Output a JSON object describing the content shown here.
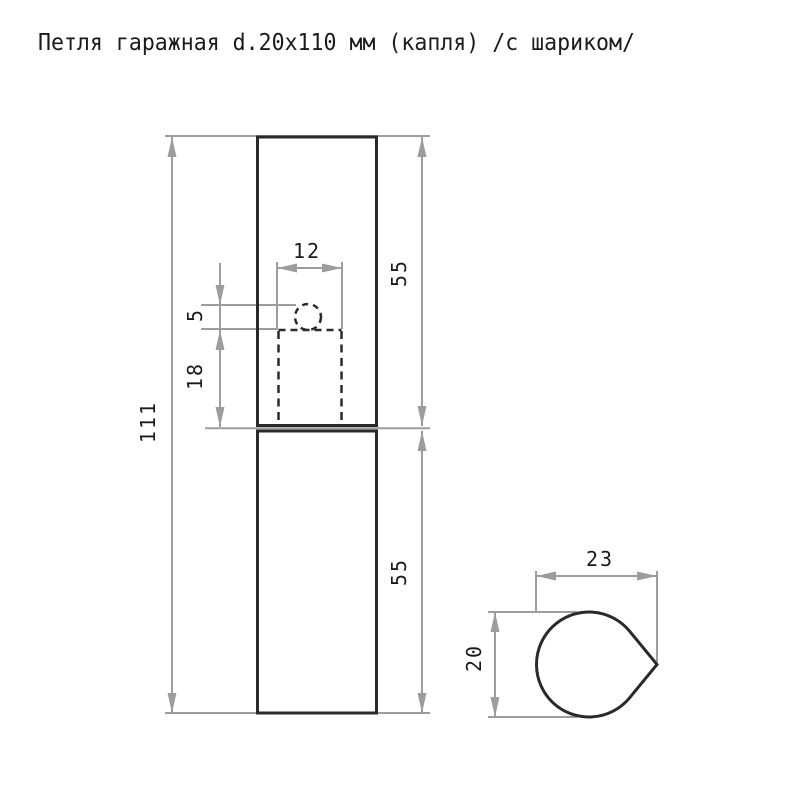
{
  "title": "Петля гаражная d.20x110 мм (капля) /с шариком/",
  "views": {
    "front_view": "hinge-front-view",
    "section_view": "teardrop-cross-section"
  },
  "dimensions": {
    "overall_length": "111",
    "upper_half_length": "55",
    "lower_half_length": "55",
    "pin_width": "12",
    "ball_offset": "5",
    "pin_socket_depth": "18",
    "profile_width": "23",
    "profile_height": "20"
  },
  "colors": {
    "background": "#ffffff",
    "outline": "#2a2a2a",
    "dimension": "#9d9d9d",
    "text": "#1b1b1b"
  }
}
